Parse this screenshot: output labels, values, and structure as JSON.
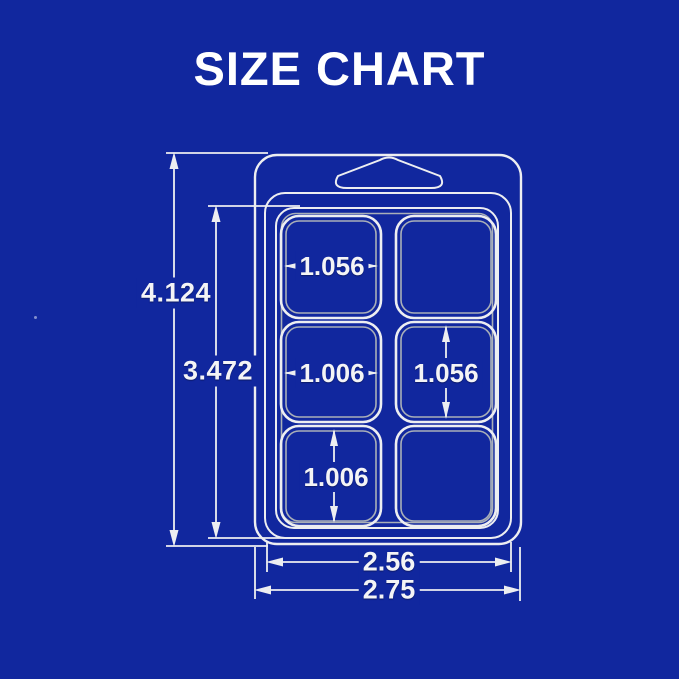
{
  "title": "SIZE CHART",
  "colors": {
    "background": "#11279E",
    "line": "#EDEEF1",
    "line_shadow": "#A9AFB8",
    "text": "#F4F4F6",
    "title_color": "#FFFFFF"
  },
  "diagram": {
    "dims": {
      "overall_height": "4.124",
      "body_height": "3.472",
      "body_width": "2.56",
      "overall_width": "2.75",
      "cavity_width_top": "1.056",
      "cavity_width_mid": "1.006",
      "cavity_height_mid": "1.056",
      "cavity_height_bottom": "1.006"
    }
  }
}
